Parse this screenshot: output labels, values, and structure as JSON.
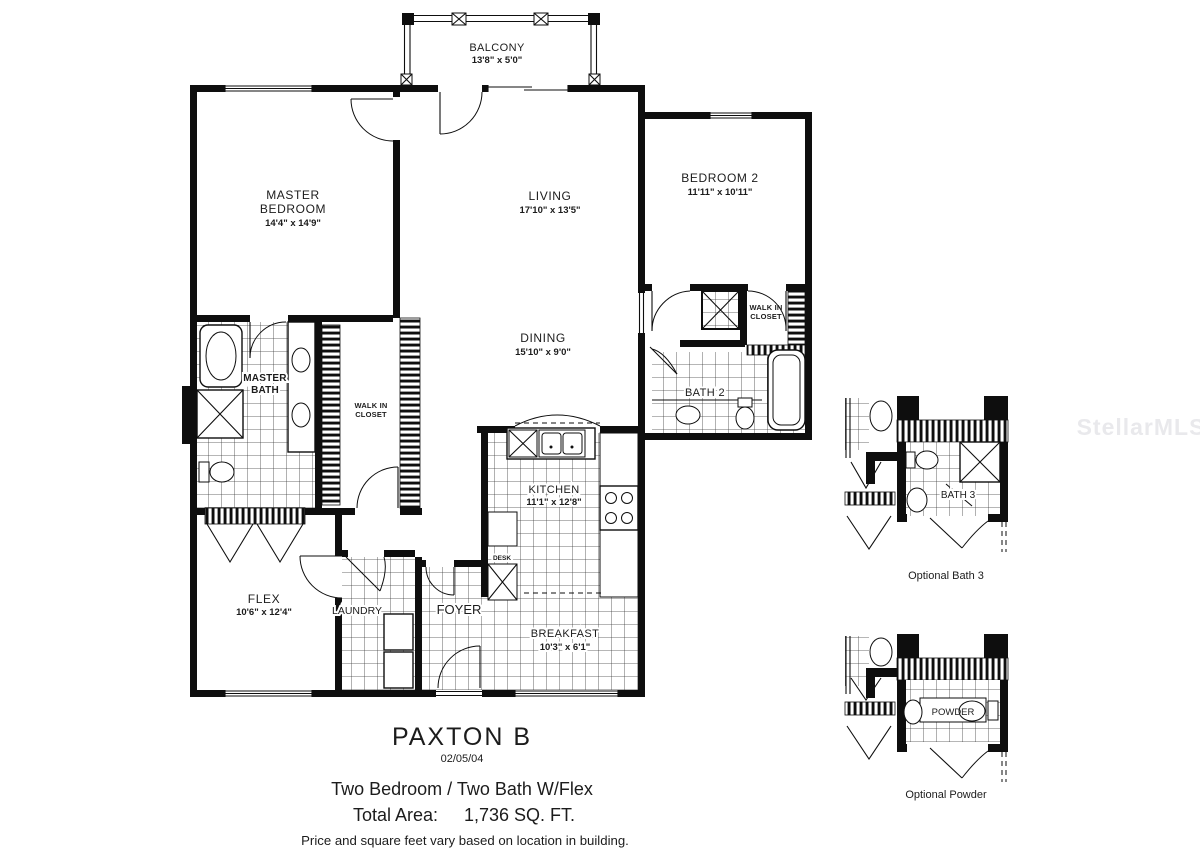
{
  "watermark": {
    "text": "StellarMLS"
  },
  "plan": {
    "balcony": {
      "name": "BALCONY",
      "dims": "13'8\" x 5'0\""
    },
    "master_bedroom": {
      "line1": "MASTER",
      "line2": "BEDROOM",
      "dims": "14'4\" x 14'9\""
    },
    "living": {
      "name": "LIVING",
      "dims": "17'10\" x 13'5\""
    },
    "bedroom2": {
      "name": "BEDROOM 2",
      "dims": "11'11\" x 10'11\""
    },
    "dining": {
      "name": "DINING",
      "dims": "15'10\" x 9'0\""
    },
    "kitchen": {
      "name": "KITCHEN",
      "dims": "11'1\" x 12'8\""
    },
    "breakfast": {
      "name": "BREAKFAST",
      "dims": "10'3\" x 6'1\""
    },
    "flex": {
      "name": "FLEX",
      "dims": "10'6\" x 12'4\""
    },
    "master_bath": {
      "line1": "MASTER",
      "line2": "BATH"
    },
    "wic_master": {
      "line1": "WALK IN",
      "line2": "CLOSET"
    },
    "wic_bedroom2": {
      "line1": "WALK IN",
      "line2": "CLOSET"
    },
    "bath2": {
      "name": "BATH 2"
    },
    "laundry": {
      "name": "LAUNDRY"
    },
    "foyer": {
      "name": "FOYER"
    },
    "desk": {
      "name": "DESK"
    }
  },
  "insets": {
    "bath3": {
      "label": "BATH 3",
      "caption": "Optional Bath 3"
    },
    "powder": {
      "label": "POWDER",
      "caption": "Optional Powder"
    }
  },
  "title_block": {
    "plan_name": "PAXTON B",
    "date": "02/05/04",
    "description": "Two Bedroom / Two Bath W/Flex",
    "total_area_label": "Total Area:",
    "total_area_value": "1,736 SQ. FT.",
    "disclaimer": "Price and square feet vary based on location in building."
  }
}
